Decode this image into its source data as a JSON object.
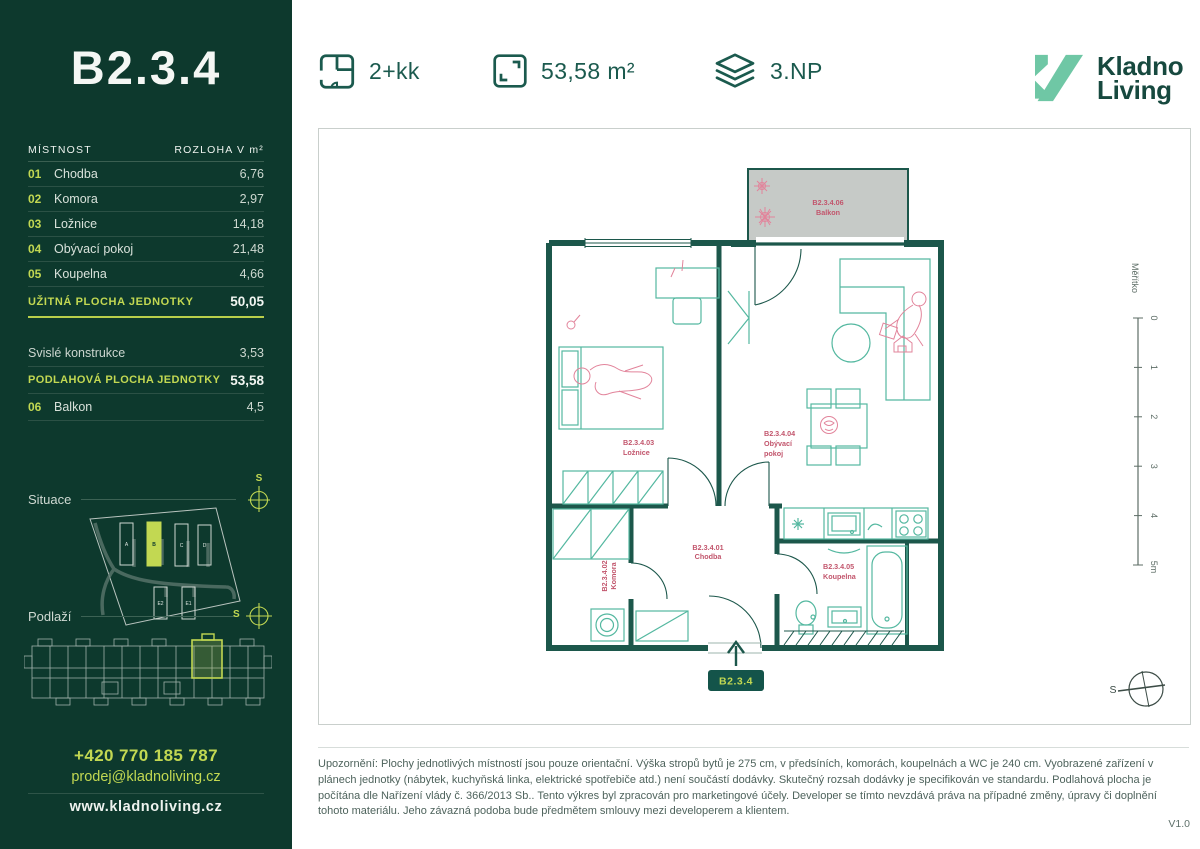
{
  "header": {
    "features": [
      {
        "icon": "floorplan-icon",
        "label": "2+kk"
      },
      {
        "icon": "area-icon",
        "label": "53,58 m²"
      },
      {
        "icon": "floor-icon",
        "label": "3.NP"
      }
    ],
    "brand": {
      "name_line1": "Kladno",
      "name_line2": "Living"
    }
  },
  "sidebar": {
    "unit_title": "B2.3.4",
    "table": {
      "col_room": "MÍSTNOST",
      "col_area": "ROZLOHA V m²",
      "rows": [
        {
          "num": "01",
          "name": "Chodba",
          "area": "6,76"
        },
        {
          "num": "02",
          "name": "Komora",
          "area": "2,97"
        },
        {
          "num": "03",
          "name": "Ložnice",
          "area": "14,18"
        },
        {
          "num": "04",
          "name": "Obývací pokoj",
          "area": "21,48"
        },
        {
          "num": "05",
          "name": "Koupelna",
          "area": "4,66"
        }
      ],
      "usable_label": "UŽITNÁ PLOCHA JEDNOTKY",
      "usable_value": "50,05",
      "construction_label": "Svislé konstrukce",
      "construction_value": "3,53",
      "floor_area_label": "PODLAHOVÁ PLOCHA JEDNOTKY",
      "floor_area_value": "53,58",
      "balcony_num": "06",
      "balcony_name": "Balkon",
      "balcony_value": "4,5"
    },
    "situace_label": "Situace",
    "podlazi_label": "Podlaží",
    "compass_letter": "S",
    "site_buildings": {
      "a": "A",
      "b": "B",
      "c": "C",
      "d": "D",
      "e2": "E2",
      "e1": "E1"
    },
    "contact": {
      "phone": "+420 770 185 787",
      "email": "prodej@kladnoliving.cz",
      "web": "www.kladnoliving.cz"
    }
  },
  "plan": {
    "rooms": {
      "hall": {
        "id": "B2.3.4.01",
        "name": "Chodba"
      },
      "storage": {
        "id": "B2.3.4.02",
        "name": "Komora"
      },
      "bedroom": {
        "id": "B2.3.4.03",
        "name": "Ložnice"
      },
      "living": {
        "id": "B2.3.4.04",
        "name_line1": "Obývací",
        "name_line2": "pokoj"
      },
      "bathroom": {
        "id": "B2.3.4.05",
        "name": "Koupelna"
      },
      "balcony": {
        "id": "B2.3.4.06",
        "name": "Balkon"
      }
    },
    "scale": {
      "title": "Měřítko",
      "ticks": [
        "0",
        "1",
        "2",
        "3",
        "4",
        "5m"
      ]
    },
    "compass_letter": "S",
    "entry_badge": "B2.3.4"
  },
  "footer": {
    "disclaimer": "Upozornění: Plochy jednotlivých místností jsou pouze orientační. Výška stropů bytů je 275 cm, v předsíních, komorách, koupelnách a WC je 240 cm. Vyobrazené zařízení v plánech jednotky (nábytek, kuchyňská linka, elektrické spotřebiče atd.) není součástí dodávky. Skutečný rozsah dodávky je specifikován ve standardu. Podlahová plocha je počítána dle Nařízení vlády č. 366/2013 Sb.. Tento výkres byl zpracován pro marketingové účely. Developer se tímto nevzdává práva na případné změny, úpravy či doplnění tohoto materiálu. Jeho závazná podoba bude předmětem smlouvy mezi developerem a klientem.",
    "version": "V1.0"
  },
  "colors": {
    "sidebar_bg": "#0d392d",
    "lime": "#c2d852",
    "dark_green": "#1b5a4e",
    "mint_logo": "#6fc7a5",
    "plan_wall": "#1c574b",
    "furniture": "#54b8a0",
    "accent_pink": "#e2849b",
    "label_red": "#c2556c",
    "balcony_gray": "#c6cac7"
  }
}
